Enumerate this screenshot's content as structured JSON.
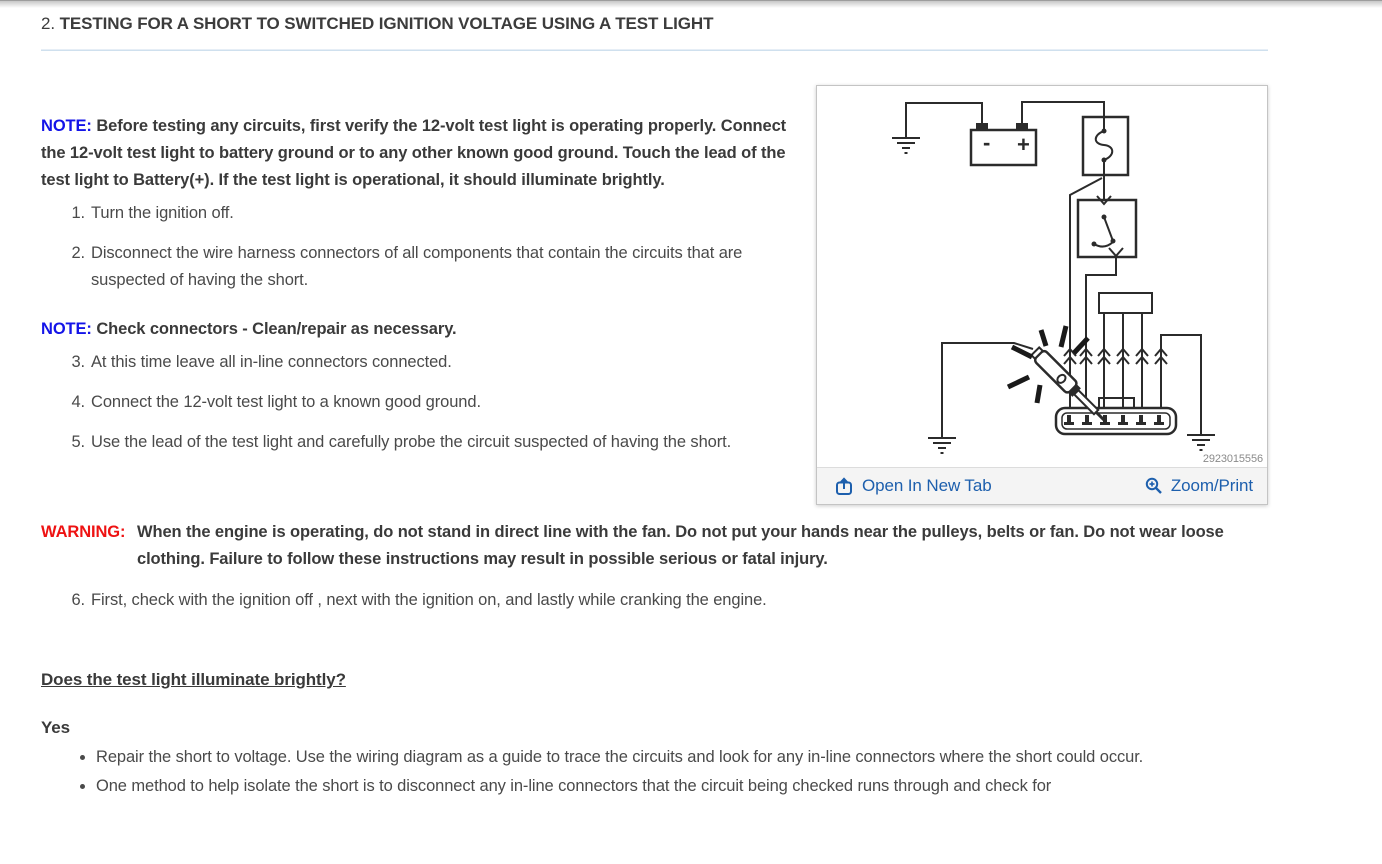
{
  "heading": {
    "number": "2.",
    "title": "TESTING FOR A SHORT TO SWITCHED IGNITION VOLTAGE USING A TEST LIGHT"
  },
  "note1": {
    "label": "NOTE:",
    "text": "Before testing any circuits, first verify the 12-volt test light is operating properly. Connect the 12-volt test light to battery ground or to any other known good ground. Touch the lead of the test light to Battery(+). If the test light is operational, it should illuminate brightly."
  },
  "note2": {
    "label": "NOTE:",
    "text": "Check connectors - Clean/repair as necessary."
  },
  "warning": {
    "label": "WARNING:",
    "text": "When the engine is operating, do not stand in direct line with the fan. Do not put your hands near the pulleys, belts or fan. Do not wear loose clothing. Failure to follow these instructions may result in possible serious or fatal injury."
  },
  "steps": [
    {
      "num": "1.",
      "text": "Turn the ignition off."
    },
    {
      "num": "2.",
      "text": "Disconnect the wire harness connectors of all components that contain the circuits that are suspected of having the short."
    },
    {
      "num": "3.",
      "text": "At this time leave all in-line connectors connected."
    },
    {
      "num": "4.",
      "text": "Connect the 12-volt test light to a known good ground."
    },
    {
      "num": "5.",
      "text": "Use the lead of the test light and carefully probe the circuit suspected of having the short."
    },
    {
      "num": "6.",
      "text": "First, check with the ignition off , next with the ignition on, and lastly while cranking the engine."
    }
  ],
  "question": "Does the test light illuminate brightly?",
  "answer": {
    "label": "Yes",
    "bullets": [
      "Repair the short to voltage. Use the wiring diagram as a guide to trace the circuits and look for any in-line connectors where the short could occur.",
      "One method to help isolate the short is to disconnect any in-line connectors that the circuit being checked runs through and check for"
    ]
  },
  "figure": {
    "number": "2923015556",
    "open_in_new_tab_label": "Open In New Tab",
    "zoom_print_label": "Zoom/Print",
    "battery_minus": "-",
    "battery_plus": "+"
  },
  "colors": {
    "note_blue": "#1414e8",
    "warning_red": "#ee1212",
    "link_blue": "#1d5fad"
  }
}
